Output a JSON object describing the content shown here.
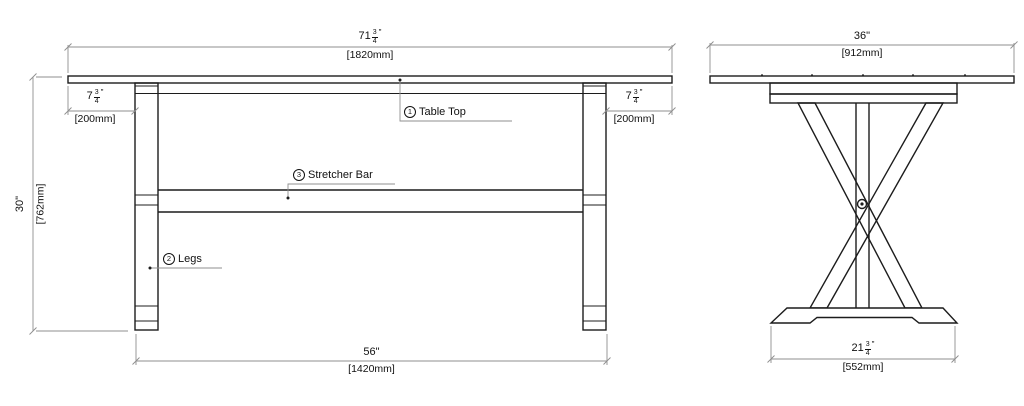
{
  "dims": {
    "front_width": {
      "whole": "71",
      "num": "3",
      "den": "4",
      "unit": "\"",
      "mm": "[1820mm]"
    },
    "front_overhang_left": {
      "whole": "7",
      "num": "3",
      "den": "4",
      "unit": "\"",
      "mm": "[200mm]"
    },
    "front_overhang_right": {
      "whole": "7",
      "num": "3",
      "den": "4",
      "unit": "\"",
      "mm": "[200mm]"
    },
    "front_height": {
      "label": "30\"",
      "mm": "[762mm]"
    },
    "front_leg_span": {
      "label": "56\"",
      "mm": "[1420mm]"
    },
    "side_width": {
      "label": "36\"",
      "mm": "[912mm]"
    },
    "side_foot": {
      "whole": "21",
      "num": "3",
      "den": "4",
      "unit": "\"",
      "mm": "[552mm]"
    }
  },
  "labels": {
    "table_top": {
      "number": "1",
      "text": "Table Top"
    },
    "legs": {
      "number": "2",
      "text": "Legs"
    },
    "stretcher_bar": {
      "number": "3",
      "text": "Stretcher Bar"
    }
  },
  "colors": {
    "line": "#1c1c1c",
    "dimension": "#8f8f8f",
    "background": "#ffffff"
  }
}
